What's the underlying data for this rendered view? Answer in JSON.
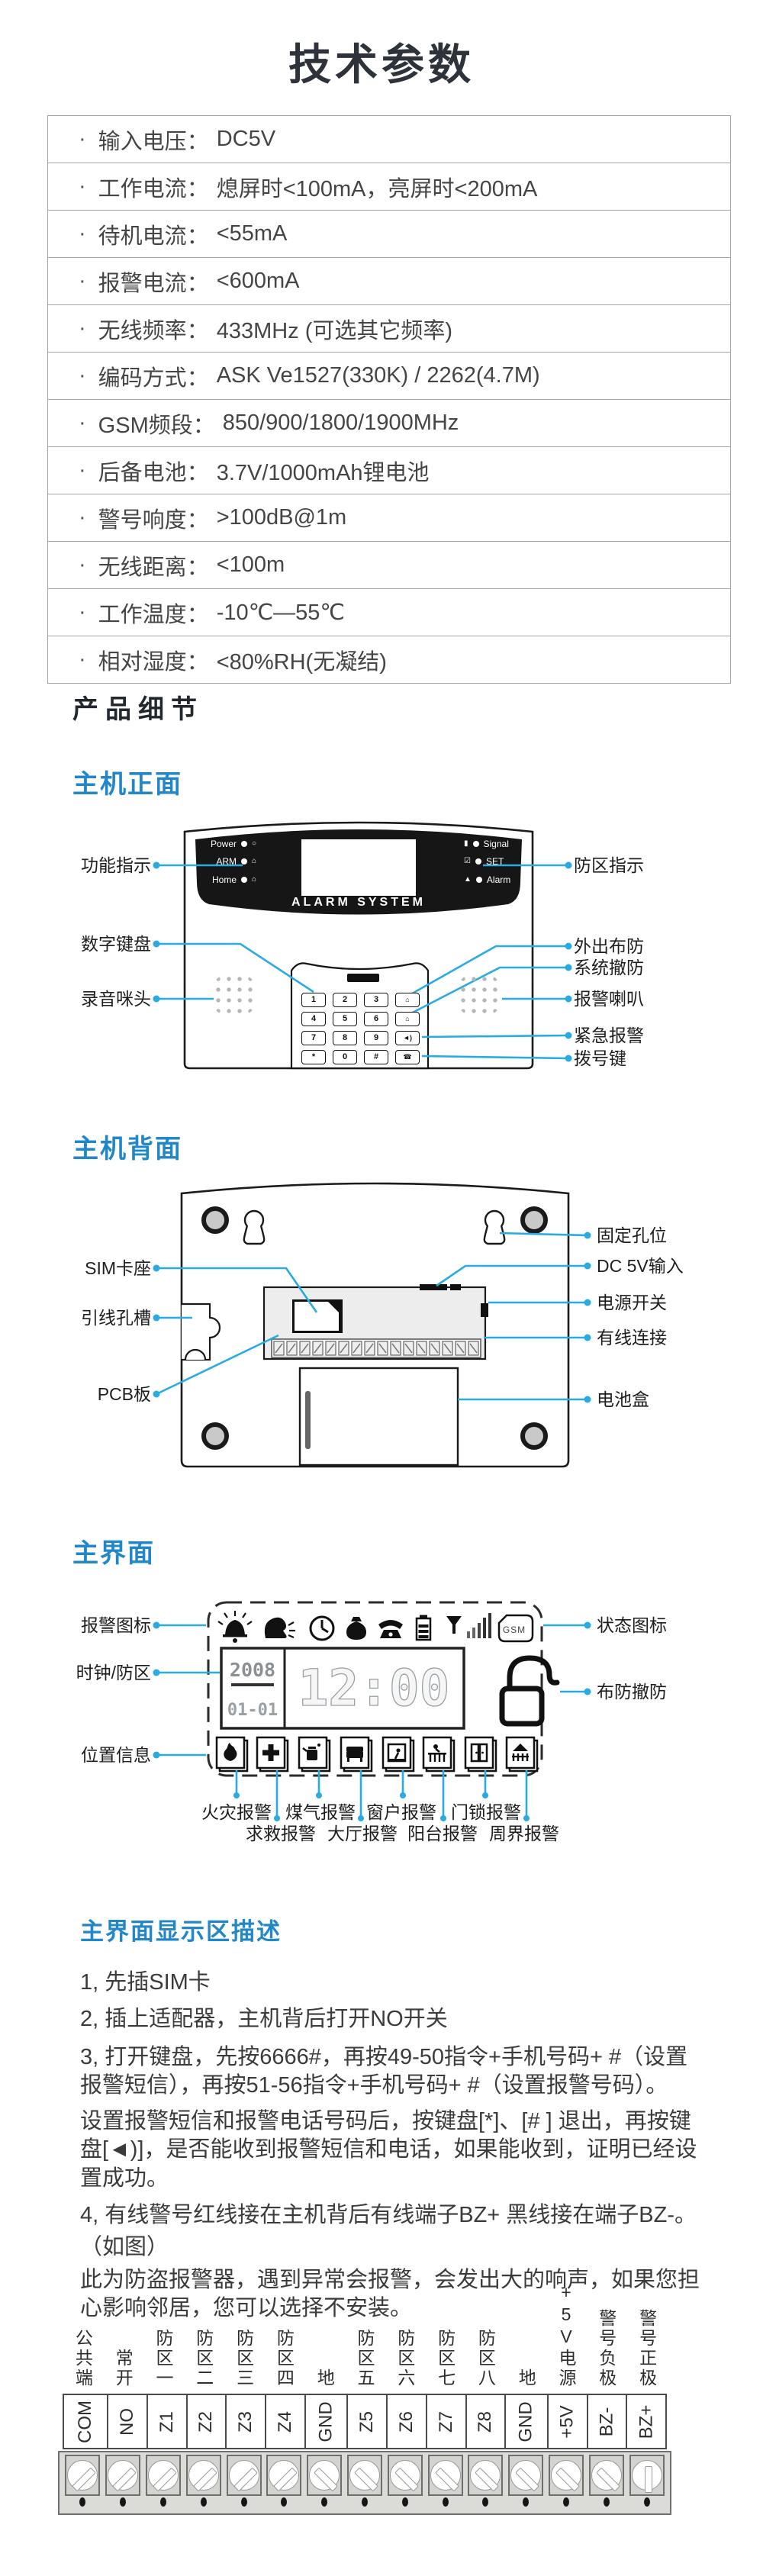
{
  "title": "技术参数",
  "specs": [
    {
      "label": "输入电压",
      "value": "DC5V"
    },
    {
      "label": "工作电流",
      "value": "熄屏时<100mA，亮屏时<200mA"
    },
    {
      "label": "待机电流",
      "value": "<55mA"
    },
    {
      "label": "报警电流",
      "value": "<600mA"
    },
    {
      "label": "无线频率",
      "value": "433MHz (可选其它频率)"
    },
    {
      "label": "编码方式",
      "value": "ASK Ve1527(330K) / 2262(4.7M)"
    },
    {
      "label": "GSM频段",
      "value": "850/900/1800/1900MHz"
    },
    {
      "label": "后备电池",
      "value": "3.7V/1000mAh锂电池"
    },
    {
      "label": "警号响度",
      "value": ">100dB@1m"
    },
    {
      "label": "无线距离",
      "value": "<100m"
    },
    {
      "label": "工作温度",
      "value": "-10℃—55℃"
    },
    {
      "label": "相对湿度",
      "value": "<80%RH(无凝结)"
    }
  ],
  "sections": {
    "details": "产品细节",
    "front": "主机正面",
    "back": "主机背面",
    "ui": "主界面",
    "desc": "主界面显示区描述"
  },
  "front": {
    "brand": "ALARM SYSTEM",
    "leds_left": [
      {
        "name": "Power",
        "icon": "○"
      },
      {
        "name": "ARM",
        "icon": "⌂"
      },
      {
        "name": "Home",
        "icon": "⌂"
      }
    ],
    "leds_right": [
      {
        "name": "Signal",
        "icon": "▮"
      },
      {
        "name": "SET",
        "icon": "☑"
      },
      {
        "name": "Alarm",
        "icon": "▲"
      }
    ],
    "keys": [
      "1",
      "2",
      "3",
      "⌂",
      "4",
      "5",
      "6",
      "⌂",
      "7",
      "8",
      "9",
      "◄)",
      "*",
      "0",
      "#",
      "☎"
    ],
    "labels_left": [
      "功能指示",
      "数字键盘",
      "录音咪头"
    ],
    "labels_right": [
      "防区指示",
      "外出布防",
      "系统撤防",
      "报警喇叭",
      "紧急报警",
      "拨号键"
    ]
  },
  "back": {
    "labels_left": [
      "SIM卡座",
      "引线孔槽",
      "PCB板"
    ],
    "labels_right": [
      "固定孔位",
      "DC 5V输入",
      "电源开关",
      "有线连接",
      "电池盒"
    ]
  },
  "lcd": {
    "gsm_label": "GSM",
    "year": "2008",
    "date": "01-01",
    "time": "12:00",
    "labels_left": [
      "报警图标",
      "时钟/防区",
      "位置信息"
    ],
    "labels_right": [
      "状态图标",
      "布防撤防"
    ],
    "zone_labels_row1": [
      "火灾报警",
      "煤气报警",
      "窗户报警",
      "门锁报警"
    ],
    "zone_labels_row2": [
      "求救报警",
      "大厅报警",
      "阳台报警",
      "周界报警"
    ],
    "icons_top": [
      "alarm-bell",
      "voice",
      "clock",
      "money-bag",
      "telephone",
      "battery",
      "signal-bars",
      "gsm-sim"
    ],
    "icons_bottom": [
      "fire",
      "sos",
      "gas",
      "hall",
      "window",
      "balcony",
      "door",
      "perimeter"
    ]
  },
  "instructions": [
    "1, 先插SIM卡",
    "2, 插上适配器，主机背后打开NO开关",
    "3, 打开键盘，先按6666#，再按49-50指令+手机号码+ #（设置",
    "报警短信），再按51-56指令+手机号码+ #（设置报警号码）。",
    "设置报警短信和报警电话号码后，按键盘[*]、[# ] 退出，再按键",
    "盘[◄)]，是否能收到报警短信和电话，如果能收到，证明已经设",
    "置成功。",
    "4, 有线警号红线接在主机背后有线端子BZ+ 黑线接在端子BZ-。",
    "（如图）",
    "此为防盗报警器，遇到异常会报警，会发出大的响声，如果您担",
    "心影响邻居，您可以选择不安装。"
  ],
  "terminal": {
    "columns": [
      {
        "cn": "公共端",
        "en": "COM"
      },
      {
        "cn": "常开",
        "en": "NO"
      },
      {
        "cn": "防区一",
        "en": "Z1"
      },
      {
        "cn": "防区二",
        "en": "Z2"
      },
      {
        "cn": "防区三",
        "en": "Z3"
      },
      {
        "cn": "防区四",
        "en": "Z4"
      },
      {
        "cn": "地",
        "en": "GND"
      },
      {
        "cn": "防区五",
        "en": "Z5"
      },
      {
        "cn": "防区六",
        "en": "Z6"
      },
      {
        "cn": "防区七",
        "en": "Z7"
      },
      {
        "cn": "防区八",
        "en": "Z8"
      },
      {
        "cn": "地",
        "en": "GND"
      },
      {
        "cn": "+5V电源",
        "en": "+5V"
      },
      {
        "cn": "警号负极",
        "en": "BZ-"
      },
      {
        "cn": "警号正极",
        "en": "BZ+"
      }
    ]
  },
  "colors": {
    "accent_blue": "#2287C8",
    "line_blue": "#29ABE2",
    "panel_black": "#161616",
    "text_dark": "#3b3b3b"
  }
}
